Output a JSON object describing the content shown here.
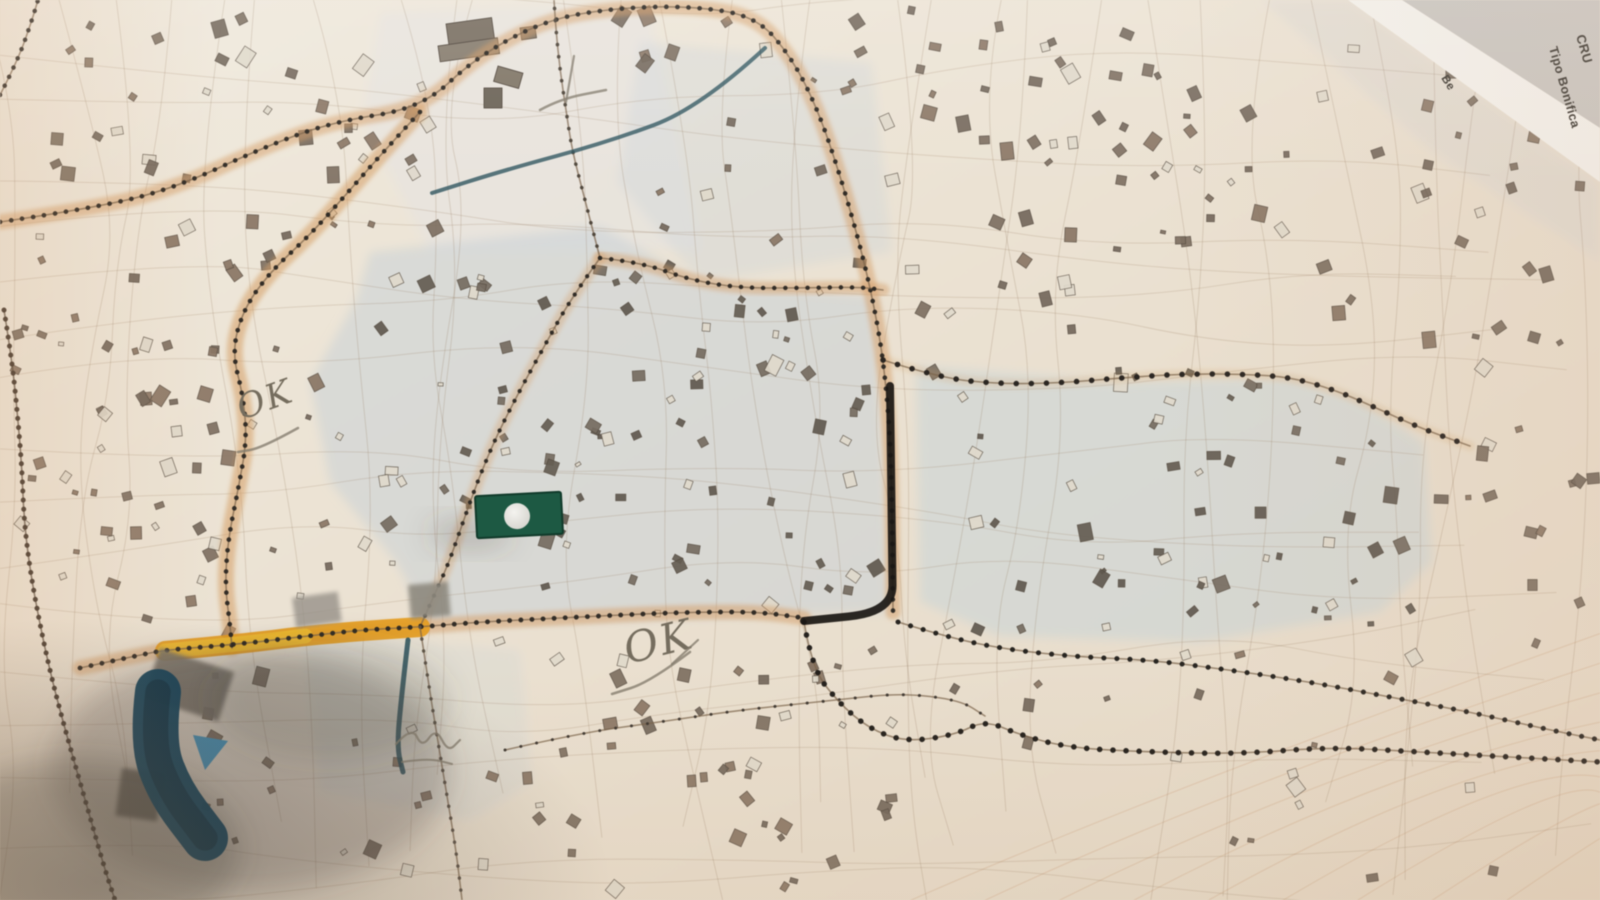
{
  "corner_labels": {
    "line1": "CRU",
    "line2": "Tipo Bonifica",
    "edge": "Be",
    "line1_size": 13,
    "line2_size": 12.5,
    "edge_size": 11.5,
    "line1_x": 1576,
    "line1_y": 36,
    "line1_rot": 74,
    "line2_x": 1549,
    "line2_y": 48,
    "line2_rot": 74,
    "edge_x": 1441,
    "edge_y": 78,
    "edge_rot": 58
  },
  "handwriting": {
    "ok1": {
      "text": "OK",
      "x": 242,
      "y": 420,
      "rot": -20,
      "size": 34
    },
    "ok2": {
      "text": "OK",
      "x": 628,
      "y": 664,
      "rot": -14,
      "size": 42
    }
  },
  "palette": {
    "paper_light": "#f0eadd",
    "paper_mid": "#eae0cf",
    "paper_warm": "#e6d9c5",
    "road_dot": "#2b2722",
    "road_line": "#7a6248",
    "orange_band": "#d79e63",
    "highlight_orange": "#e89c18",
    "highlight_yellow": "#f5c42e",
    "marker_ink": "#1a1714",
    "teal_ink": "#2e5560",
    "green_marker": "#1b5a43",
    "blue_marker": "#16435a",
    "blue_triangle": "#4585a6",
    "pencil": "#837b6c",
    "wash_blue": "#c5cfd8",
    "shadow": "#4a463f",
    "building_a": "#8a7563",
    "building_b": "#7d6f5f",
    "building_c": "#73675a",
    "building_dark": "#645c51",
    "contour": "#d0a27f"
  },
  "washes": [
    {
      "pts": [
        [
          380,
          12
        ],
        [
          648,
          2
        ],
        [
          700,
          250
        ],
        [
          430,
          252
        ],
        [
          362,
          120
        ]
      ],
      "fill": "#e6e4e0",
      "op": 0.65
    },
    {
      "pts": [
        [
          640,
          42
        ],
        [
          872,
          62
        ],
        [
          892,
          252
        ],
        [
          700,
          282
        ],
        [
          618,
          182
        ]
      ],
      "fill": "#ccd5db",
      "op": 0.38
    },
    {
      "pts": [
        [
          370,
          252
        ],
        [
          600,
          226
        ],
        [
          700,
          282
        ],
        [
          876,
          296
        ],
        [
          890,
          612
        ],
        [
          430,
          626
        ],
        [
          396,
          562
        ],
        [
          330,
          482
        ],
        [
          310,
          382
        ],
        [
          356,
          300
        ]
      ],
      "fill": "#c5cfd8",
      "op": 0.5
    },
    {
      "pts": [
        [
          916,
          366
        ],
        [
          1120,
          382
        ],
        [
          1290,
          378
        ],
        [
          1360,
          400
        ],
        [
          1424,
          442
        ],
        [
          1432,
          562
        ],
        [
          1380,
          612
        ],
        [
          1200,
          642
        ],
        [
          1000,
          636
        ],
        [
          920,
          602
        ]
      ],
      "fill": "#c6d2d8",
      "op": 0.52
    },
    {
      "pts": [
        [
          302,
          632
        ],
        [
          520,
          650
        ],
        [
          532,
          782
        ],
        [
          470,
          820
        ],
        [
          320,
          792
        ]
      ],
      "fill": "#ccd3d8",
      "op": 0.3
    },
    {
      "pts": [
        [
          1262,
          0
        ],
        [
          1350,
          0
        ],
        [
          1600,
          184
        ],
        [
          1600,
          262
        ],
        [
          1430,
          150
        ]
      ],
      "fill": "#d9d7d3",
      "op": 0.45
    }
  ],
  "roads": [
    {
      "pts": [
        [
          0,
          222
        ],
        [
          95,
          208
        ],
        [
          175,
          188
        ],
        [
          262,
          148
        ],
        [
          332,
          122
        ],
        [
          422,
          108
        ],
        [
          475,
          58
        ],
        [
          545,
          20
        ],
        [
          615,
          8
        ],
        [
          690,
          6
        ],
        [
          756,
          16
        ],
        [
          792,
          58
        ],
        [
          818,
          110
        ],
        [
          840,
          175
        ],
        [
          860,
          245
        ],
        [
          874,
          305
        ],
        [
          884,
          365
        ],
        [
          890,
          435
        ],
        [
          892,
          505
        ],
        [
          893,
          612
        ]
      ],
      "band": 0.5,
      "bandW": 15,
      "dotW": 4.6,
      "dotGap": 11
    },
    {
      "pts": [
        [
          420,
          112
        ],
        [
          385,
          150
        ],
        [
          350,
          190
        ],
        [
          310,
          235
        ],
        [
          270,
          272
        ],
        [
          243,
          310
        ],
        [
          232,
          352
        ],
        [
          243,
          395
        ],
        [
          247,
          440
        ],
        [
          238,
          490
        ],
        [
          228,
          540
        ],
        [
          225,
          585
        ],
        [
          230,
          625
        ],
        [
          232,
          648
        ]
      ],
      "band": 0.55,
      "bandW": 16,
      "dotW": 4.6,
      "dotGap": 10.5
    },
    {
      "pts": [
        [
          80,
          668
        ],
        [
          140,
          655
        ],
        [
          165,
          650
        ],
        [
          230,
          645
        ],
        [
          300,
          637
        ],
        [
          360,
          630
        ],
        [
          420,
          627
        ],
        [
          480,
          622
        ],
        [
          560,
          618
        ],
        [
          640,
          614
        ],
        [
          700,
          612
        ],
        [
          760,
          612
        ],
        [
          804,
          618
        ]
      ],
      "band": 0.5,
      "bandW": 15,
      "dotW": 4.8,
      "dotGap": 11
    },
    {
      "pts": [
        [
          600,
          258
        ],
        [
          570,
          300
        ],
        [
          545,
          345
        ],
        [
          520,
          390
        ],
        [
          497,
          435
        ],
        [
          478,
          480
        ],
        [
          462,
          525
        ],
        [
          448,
          565
        ],
        [
          432,
          600
        ],
        [
          420,
          627
        ]
      ],
      "band": 0.35,
      "bandW": 12,
      "dotW": 4.2,
      "dotGap": 11
    },
    {
      "pts": [
        [
          600,
          258
        ],
        [
          585,
          200
        ],
        [
          572,
          150
        ],
        [
          566,
          110
        ],
        [
          560,
          70
        ],
        [
          556,
          30
        ],
        [
          554,
          0
        ]
      ],
      "band": 0,
      "dotW": 3.6,
      "dotGap": 12,
      "dotC": "#4b4238"
    },
    {
      "pts": [
        [
          600,
          258
        ],
        [
          640,
          262
        ],
        [
          690,
          280
        ],
        [
          740,
          288
        ],
        [
          800,
          288
        ],
        [
          860,
          287
        ],
        [
          883,
          290
        ]
      ],
      "band": 0.45,
      "bandW": 13,
      "dotW": 4.4,
      "dotGap": 11
    },
    {
      "pts": [
        [
          883,
          360
        ],
        [
          940,
          378
        ],
        [
          1000,
          384
        ],
        [
          1060,
          383
        ],
        [
          1120,
          378
        ],
        [
          1180,
          374
        ],
        [
          1240,
          374
        ],
        [
          1290,
          377
        ],
        [
          1335,
          390
        ],
        [
          1372,
          406
        ],
        [
          1420,
          428
        ],
        [
          1470,
          446
        ]
      ],
      "band": 0.2,
      "bandW": 10,
      "dotW": 5.5,
      "dotGap": 15,
      "dotC": "#24201c"
    },
    {
      "pts": [
        [
          898,
          622
        ],
        [
          950,
          638
        ],
        [
          1010,
          650
        ],
        [
          1080,
          657
        ],
        [
          1150,
          660
        ],
        [
          1230,
          670
        ],
        [
          1310,
          682
        ],
        [
          1390,
          697
        ],
        [
          1470,
          712
        ],
        [
          1550,
          730
        ],
        [
          1600,
          740
        ]
      ],
      "band": 0,
      "dotW": 5,
      "dotGap": 13,
      "dotC": "#201d1a"
    },
    {
      "pts": [
        [
          4,
          310
        ],
        [
          12,
          360
        ],
        [
          18,
          420
        ],
        [
          22,
          470
        ],
        [
          24,
          520
        ],
        [
          30,
          570
        ],
        [
          40,
          625
        ],
        [
          52,
          680
        ],
        [
          68,
          740
        ],
        [
          88,
          810
        ],
        [
          105,
          870
        ],
        [
          115,
          900
        ]
      ],
      "band": 0,
      "dotW": 5,
      "dotGap": 9,
      "dotC": "#44382c",
      "lineC": "#5a4a3a"
    },
    {
      "pts": [
        [
          0,
          95
        ],
        [
          18,
          60
        ],
        [
          32,
          20
        ],
        [
          38,
          0
        ]
      ],
      "band": 0,
      "dotW": 4.5,
      "dotGap": 10
    },
    {
      "pts": [
        [
          420,
          627
        ],
        [
          428,
          680
        ],
        [
          436,
          730
        ],
        [
          446,
          790
        ],
        [
          456,
          850
        ],
        [
          462,
          900
        ]
      ],
      "band": 0,
      "dotW": 3.4,
      "dotGap": 12,
      "dotC": "#5a5045"
    },
    {
      "pts": [
        [
          505,
          750
        ],
        [
          580,
          733
        ],
        [
          660,
          722
        ],
        [
          740,
          710
        ],
        [
          837,
          700
        ],
        [
          900,
          693
        ],
        [
          960,
          700
        ],
        [
          985,
          716
        ]
      ],
      "band": 0,
      "dotW": 3,
      "dotGap": 16,
      "dotC": "#3c362f"
    },
    {
      "pts": [
        [
          804,
          622
        ],
        [
          812,
          668
        ],
        [
          838,
          702
        ],
        [
          868,
          728
        ],
        [
          905,
          742
        ],
        [
          955,
          735
        ],
        [
          985,
          720
        ],
        [
          1020,
          735
        ],
        [
          1070,
          748
        ],
        [
          1150,
          752
        ],
        [
          1240,
          754
        ],
        [
          1330,
          747
        ],
        [
          1420,
          752
        ],
        [
          1510,
          757
        ],
        [
          1600,
          762
        ]
      ],
      "band": 0,
      "dotW": 5.5,
      "dotGap": 13,
      "dotC": "#1d1a17"
    }
  ],
  "highlight": {
    "pts": [
      [
        165,
        651
      ],
      [
        240,
        644
      ],
      [
        320,
        634
      ],
      [
        420,
        627
      ]
    ],
    "w": 20,
    "w2": 15,
    "sub_pts": [
      [
        165,
        651
      ],
      [
        240,
        644
      ],
      [
        305,
        636
      ]
    ]
  },
  "marker_lines": [
    {
      "pts": [
        [
          890,
          386
        ],
        [
          892,
          558
        ],
        [
          893,
          612
        ],
        [
          804,
          621
        ]
      ],
      "w": 8,
      "c": "#1a1714",
      "op": 0.92
    }
  ],
  "teal_lines": [
    {
      "pts": [
        [
          765,
          48
        ],
        [
          700,
          108
        ],
        [
          608,
          142
        ],
        [
          505,
          170
        ],
        [
          432,
          193
        ]
      ],
      "w": 4,
      "c": "#2e5560",
      "op": 0.8
    },
    {
      "pts": [
        [
          408,
          640
        ],
        [
          401,
          700
        ],
        [
          397,
          748
        ],
        [
          403,
          772
        ]
      ],
      "w": 5,
      "c": "#27505c",
      "op": 0.85
    }
  ],
  "green_marker": {
    "x": 476,
    "y": 494,
    "w": 86,
    "h": 42,
    "rot": -3,
    "fill": "#1b5a43",
    "edge": "#0f3a2a",
    "circle": {
      "cx": 517,
      "cy": 516,
      "r": 13
    }
  },
  "blue_marker": {
    "band_pts": [
      [
        158,
        692
      ],
      [
        152,
        742
      ],
      [
        170,
        792
      ],
      [
        205,
        838
      ]
    ],
    "w": 46,
    "fill": "#16435a",
    "core": "#102f40",
    "triangle": [
      [
        193,
        735
      ],
      [
        228,
        741
      ],
      [
        205,
        770
      ]
    ],
    "triangle_fill": "#4585a6"
  },
  "gray_patches": [
    {
      "x": 160,
      "y": 648,
      "w": 78,
      "h": 52,
      "rot": 18,
      "fill": "#7b7569",
      "op": 0.9
    },
    {
      "x": 122,
      "y": 768,
      "w": 42,
      "h": 48,
      "rot": 8,
      "fill": "#6d6a61",
      "op": 0.9
    },
    {
      "x": 408,
      "y": 585,
      "w": 40,
      "h": 34,
      "rot": -5,
      "fill": "#8d887e",
      "op": 0.9
    },
    {
      "x": 292,
      "y": 598,
      "w": 46,
      "h": 30,
      "rot": -8,
      "fill": "#97918a",
      "op": 0.8
    }
  ],
  "landmarks": [
    {
      "x": 446,
      "y": 24,
      "w": 46,
      "h": 24,
      "rot": -8,
      "fill": "#7c7264"
    },
    {
      "x": 438,
      "y": 46,
      "w": 60,
      "h": 16,
      "rot": -8,
      "fill": "#8a8071"
    },
    {
      "x": 520,
      "y": 28,
      "w": 15,
      "h": 12,
      "rot": -8,
      "fill": "#7c7264"
    },
    {
      "x": 498,
      "y": 66,
      "w": 26,
      "h": 16,
      "rot": 16,
      "fill": "#837969"
    },
    {
      "x": 484,
      "y": 88,
      "w": 18,
      "h": 20,
      "rot": 0,
      "fill": "#6f675a"
    }
  ],
  "shadows": [
    {
      "cx": 250,
      "cy": 770,
      "rx": 200,
      "ry": 120,
      "op": 0.28
    },
    {
      "cx": 80,
      "cy": 850,
      "rx": 160,
      "ry": 90,
      "op": 0.3
    },
    {
      "cx": 330,
      "cy": 700,
      "rx": 120,
      "ry": 60,
      "op": 0.18
    },
    {
      "cx": 470,
      "cy": 534,
      "rx": 42,
      "ry": 14,
      "op": 0.25
    }
  ],
  "pencil_paths": [
    {
      "pts": [
        [
          298,
          428
        ],
        [
          262,
          448
        ],
        [
          238,
          452
        ]
      ],
      "w": 2.5
    },
    {
      "pts": [
        [
          690,
          652
        ],
        [
          650,
          682
        ],
        [
          612,
          694
        ]
      ],
      "w": 2.5
    },
    {
      "pts": [
        [
          698,
          640
        ],
        [
          672,
          664
        ]
      ],
      "w": 2.2
    },
    {
      "pts": [
        [
          540,
          110
        ],
        [
          560,
          99
        ],
        [
          606,
          90
        ]
      ],
      "w": 2.5
    },
    {
      "pts": [
        [
          574,
          56
        ],
        [
          566,
          102
        ]
      ],
      "w": 2.2
    },
    {
      "pts": [
        [
          396,
          744
        ],
        [
          412,
          726
        ],
        [
          422,
          748
        ],
        [
          436,
          728
        ],
        [
          448,
          752
        ],
        [
          460,
          740
        ]
      ],
      "w": 2.2
    },
    {
      "pts": [
        [
          402,
          762
        ],
        [
          428,
          758
        ],
        [
          452,
          764
        ]
      ],
      "w": 2.0
    }
  ],
  "corner_geo": {
    "outer": [
      [
        1402,
        0
      ],
      [
        1600,
        0
      ],
      [
        1600,
        128
      ]
    ],
    "band": [
      [
        1348,
        0
      ],
      [
        1402,
        0
      ],
      [
        1600,
        128
      ],
      [
        1600,
        182
      ]
    ],
    "outer_fill": "#c9c6c1",
    "band_fill": "#f4f2ed"
  },
  "texture": {
    "seed": 7,
    "building_clusters": [
      {
        "x": 20,
        "y": 15,
        "w": 350,
        "h": 270,
        "n": 42
      },
      {
        "x": 10,
        "y": 290,
        "w": 200,
        "h": 330,
        "n": 30
      },
      {
        "x": 60,
        "y": 300,
        "w": 280,
        "h": 300,
        "n": 26
      },
      {
        "x": 360,
        "y": 255,
        "w": 510,
        "h": 360,
        "n": 95,
        "dark": true
      },
      {
        "x": 620,
        "y": 0,
        "w": 290,
        "h": 55,
        "n": 10
      },
      {
        "x": 640,
        "y": 70,
        "w": 250,
        "h": 180,
        "n": 12
      },
      {
        "x": 900,
        "y": 20,
        "w": 480,
        "h": 330,
        "n": 64
      },
      {
        "x": 1380,
        "y": 60,
        "w": 210,
        "h": 300,
        "n": 22
      },
      {
        "x": 925,
        "y": 360,
        "w": 490,
        "h": 270,
        "n": 58,
        "dark": true
      },
      {
        "x": 440,
        "y": 635,
        "w": 480,
        "h": 250,
        "n": 48
      },
      {
        "x": 200,
        "y": 620,
        "w": 230,
        "h": 260,
        "n": 18
      },
      {
        "x": 950,
        "y": 650,
        "w": 600,
        "h": 230,
        "n": 20
      },
      {
        "x": 1430,
        "y": 420,
        "w": 160,
        "h": 220,
        "n": 14
      },
      {
        "x": 330,
        "y": 60,
        "w": 120,
        "h": 180,
        "n": 8
      }
    ],
    "parcel_verticals": 30,
    "parcel_horizontals": 17,
    "contours": 9
  }
}
